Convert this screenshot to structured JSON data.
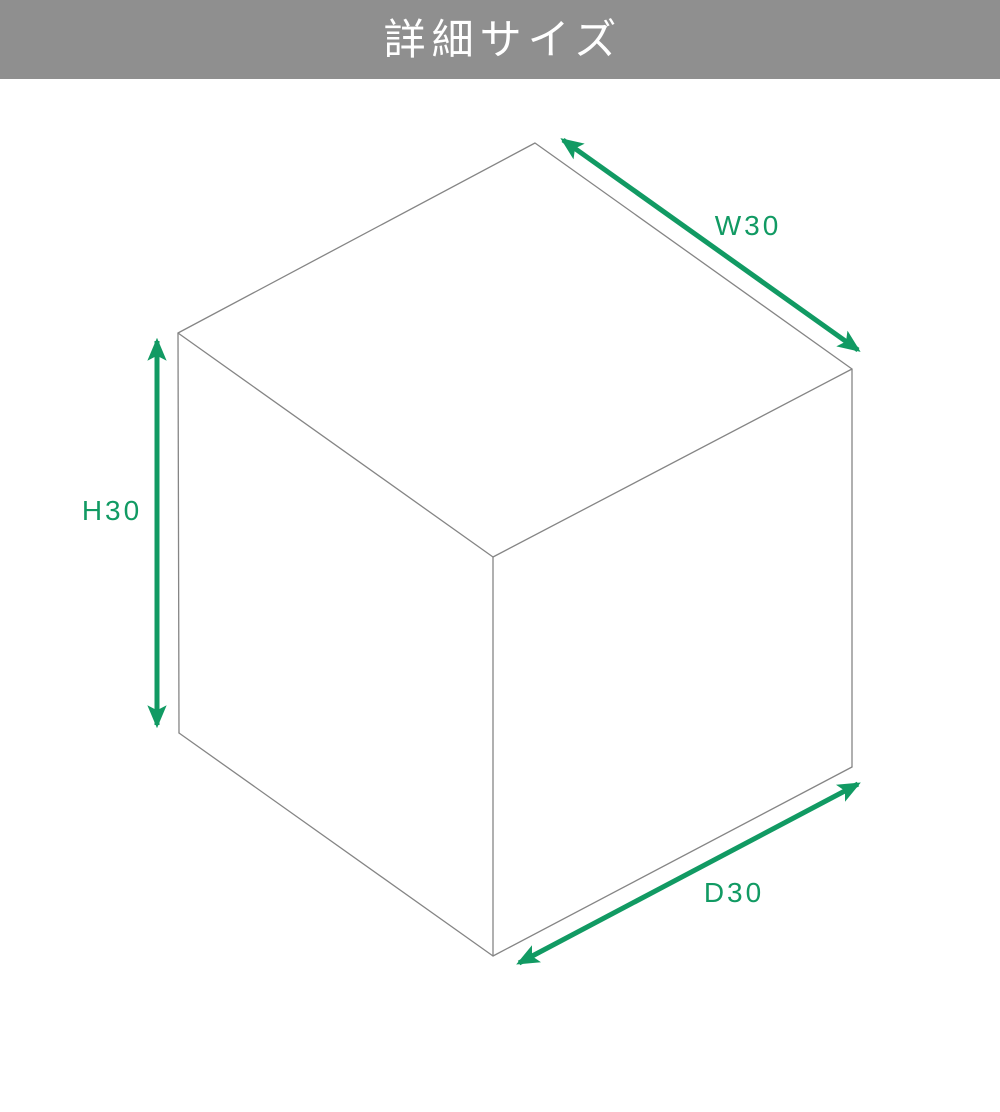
{
  "header": {
    "title": "詳細サイズ"
  },
  "diagram": {
    "shape": "isometric-cube-wireframe",
    "dimensions": {
      "width_label": "W30",
      "height_label": "H30",
      "depth_label": "D30"
    },
    "colors": {
      "accent": "#119a63",
      "header_bg": "#8f8f8f",
      "cube_line": "#858585"
    }
  }
}
